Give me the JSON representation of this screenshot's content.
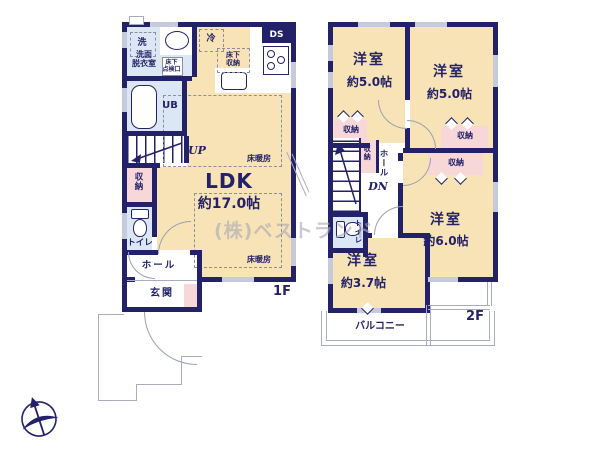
{
  "watermark": "(株)ベストランド",
  "colors": {
    "wall_navy": "#232268",
    "room_beige": "#f7e3b5",
    "wet_blue": "#dbe7f4",
    "closet_pink": "#f8d7d9"
  },
  "f1": {
    "label": "1F",
    "up": "UP",
    "laundry": "洗",
    "washroom1": "洗面",
    "washroom2": "脱衣室",
    "hatch1": "床下",
    "hatch2": "点検口",
    "ub": "UB",
    "ds": "DS",
    "fridge": "冷",
    "ufs1": "床下",
    "ufs2": "収納",
    "ldk": "LDK",
    "ldk_size": "約17.0帖",
    "heating": "床暖房",
    "storage": "収納",
    "toilet": "トイレ",
    "hall": "ホール",
    "entrance": "玄関"
  },
  "f2": {
    "label": "2F",
    "dn": "DN",
    "room": "洋室",
    "r50": "約5.0帖",
    "r60": "約6.0帖",
    "r37": "約3.7帖",
    "storage": "収納",
    "hall": "ホール",
    "toilet": "トイレ",
    "balcony": "バルコニー"
  }
}
